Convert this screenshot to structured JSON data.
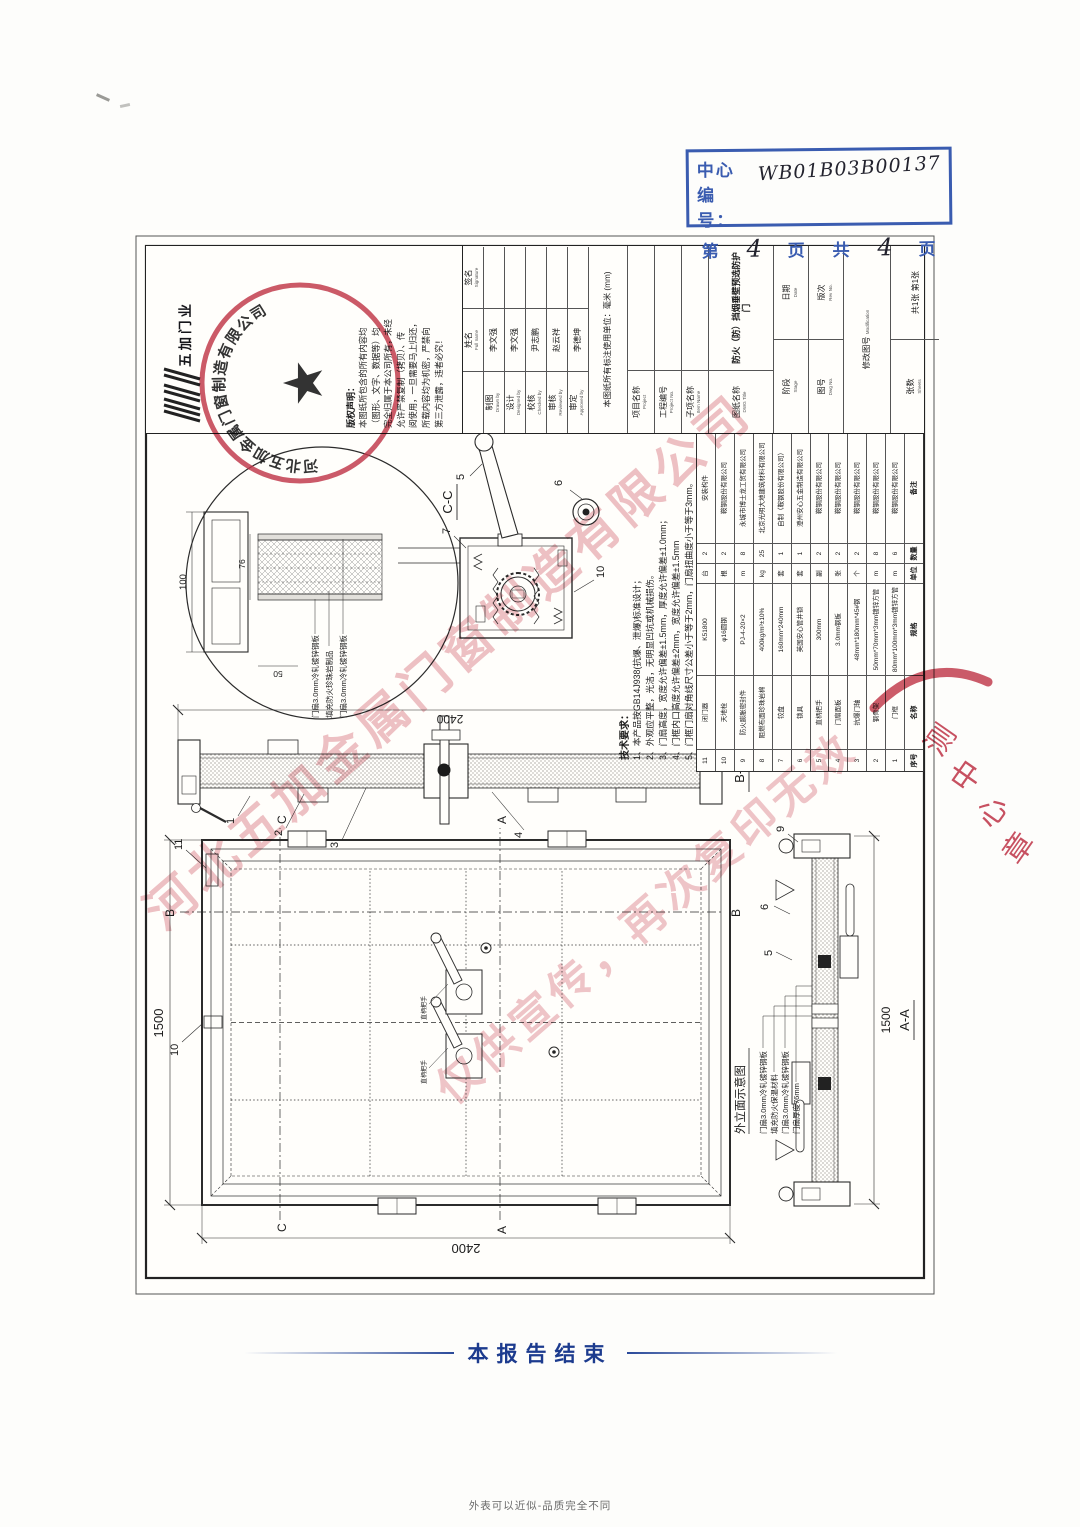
{
  "header": {
    "center_label": "中心编号：",
    "center_value": "WB01B03B00137",
    "page": {
      "prefix": "第",
      "num": "4",
      "label1": "页",
      "label2": "共",
      "total": "4",
      "label3": "页"
    }
  },
  "logo": {
    "name": "五加门业"
  },
  "stamp": {
    "company": "河北五加金属门窗制造有限公司",
    "star": "★"
  },
  "partial_stamp": {
    "ch1": "测",
    "ch2": "中",
    "ch3": "心",
    "ch4": "章"
  },
  "watermark": {
    "line1": "河北五加金属门窗制造有限公司",
    "line2": "仅供宣传，再次复印无效"
  },
  "copyright": {
    "title": "版权声明：",
    "lines": [
      "本图纸所包含的所有内容均",
      "（图形、文字、数据等）均",
      "完全归属于本公司所有，未经",
      "允许严禁复制（拷贝）、传",
      "阅使用，一旦需要马上归还，",
      "所载内容均为机密，严禁向",
      "第三方泄露，违者必究！"
    ]
  },
  "tech_notes": {
    "title": "技术要求：",
    "lines": [
      "1、本产品按GB14J938(抗爆、泄爆)标准设计；",
      "2、外观应平整，光洁，无明显凹坑或机械损伤。",
      "3、门扇高度，宽度允许偏差±1.5mm，厚度允许偏差±1.0mm；",
      "4、门框内口高度允许偏差±2mm，宽度允许偏差±1.5mm",
      "5、门框门扇对角线尺寸公差小于等于2mm，门扇扭曲度小于等于3mm。"
    ]
  },
  "bom": {
    "headers": [
      "序号",
      "名称",
      "规格",
      "单位",
      "数量",
      "备注"
    ],
    "rows": [
      [
        "11",
        "闭门器",
        "K51800",
        "台",
        "2",
        "安装构件"
      ],
      [
        "10",
        "天地栓",
        "φ16圆钢",
        "根",
        "2",
        "鞍钢股份有限公司"
      ],
      [
        "9",
        "防火膨胀密封件",
        "PJ-4-20×2",
        "m",
        "8",
        "永城市博士龙工贸有限公司"
      ],
      [
        "8",
        "阻燃布面珍珠岩棉",
        "400kg/m³±10%",
        "kg",
        "25",
        "北京光明大地建筑材料有限公司"
      ],
      [
        "7",
        "铰盘",
        "160mm*240mm",
        "套",
        "1",
        "自制（鞍钢股份有限公司）"
      ],
      [
        "6",
        "锁具",
        "英国安心管井锁",
        "套",
        "1",
        "澄州安心五金制造有限公司"
      ],
      [
        "5",
        "直柄把手",
        "300mm",
        "副",
        "2",
        "鞍钢股份有限公司"
      ],
      [
        "4",
        "门扇面板",
        "3.0mm钢板",
        "张",
        "2",
        "鞍钢股份有限公司"
      ],
      [
        "3",
        "抗爆门轴",
        "48mm*180mm*45#钢",
        "个",
        "2",
        "鞍钢股份有限公司"
      ],
      [
        "2",
        "钢骨架",
        "50mm*70mm*3mm镀锌方管",
        "m",
        "8",
        "鞍钢股份有限公司"
      ],
      [
        "1",
        "门框",
        "80mm*100mm*3mm镀锌方管",
        "m",
        "6",
        "鞍钢股份有限公司"
      ]
    ]
  },
  "title_block": {
    "name_header": "姓名",
    "name_header_en": "Full name",
    "sign_header": "签名",
    "sign_header_en": "Signature",
    "rows": [
      {
        "label": "制图",
        "en": "Drawn by",
        "name": "李文强"
      },
      {
        "label": "设计",
        "en": "Designed by",
        "name": "李文强"
      },
      {
        "label": "校核",
        "en": "Checked by",
        "name": "尹志鹏"
      },
      {
        "label": "审核",
        "en": "Reviewed by",
        "name": "赵云祥"
      },
      {
        "label": "审定",
        "en": "Approved by",
        "name": "李德坤"
      }
    ],
    "unit_note": "本图纸所有标注使用单位：毫米 (mm)",
    "project_label": "项目名称",
    "project_en": "Project",
    "eng_no_label": "工程编号",
    "eng_no_en": "Project No.",
    "item_label": "子项名称",
    "item_en": "Item Name",
    "dwg_label": "图纸名称",
    "dwg_en": "DWG Title",
    "dwg_title": "防火（防）挡烟垂壁预选防护门",
    "stage_label": "阶段",
    "stage_en": "Stage",
    "date_label": "日期",
    "date_en": "Date",
    "dwgno_label": "图号",
    "dwgno_en": "Dwg No.",
    "rev_label": "版次",
    "rev_en": "Rev No.",
    "mod_label": "修改图号",
    "mod_en": "Modification",
    "sheets_label": "张数",
    "sheets_en": "Sheets",
    "sheets_value": "共1张 第1张"
  },
  "drawing": {
    "dims": {
      "w": "1500",
      "h": "2400",
      "d100": "100",
      "d50": "50",
      "d76": "76"
    },
    "sections": {
      "aa": "A-A",
      "bb": "B-B",
      "cc": "C-C",
      "a": "A",
      "b": "B",
      "c": "C"
    },
    "callouts": {
      "c1": "1",
      "c2": "2",
      "c3": "3",
      "c4": "4",
      "c5": "5",
      "c6": "6",
      "c7": "7",
      "c9": "9",
      "c10": "10",
      "c11": "11"
    },
    "caption": "外立面示意图",
    "cc_labels": [
      "门扇3.0mm冷轧镀锌钢板",
      "填充防火珍珠岩制品",
      "门扇3.0mm冷轧镀锌钢板"
    ],
    "aa_labels": [
      "门扇3.0mm冷轧镀锌钢板",
      "填充防火保温材料",
      "门扇3.0mm冷轧镀锌钢板",
      "门扇厚度76mm"
    ],
    "handle_label": "直柄把手"
  },
  "footer": {
    "report_end": "本报告结束",
    "caption": "外表可以近似-品质完全不同"
  }
}
